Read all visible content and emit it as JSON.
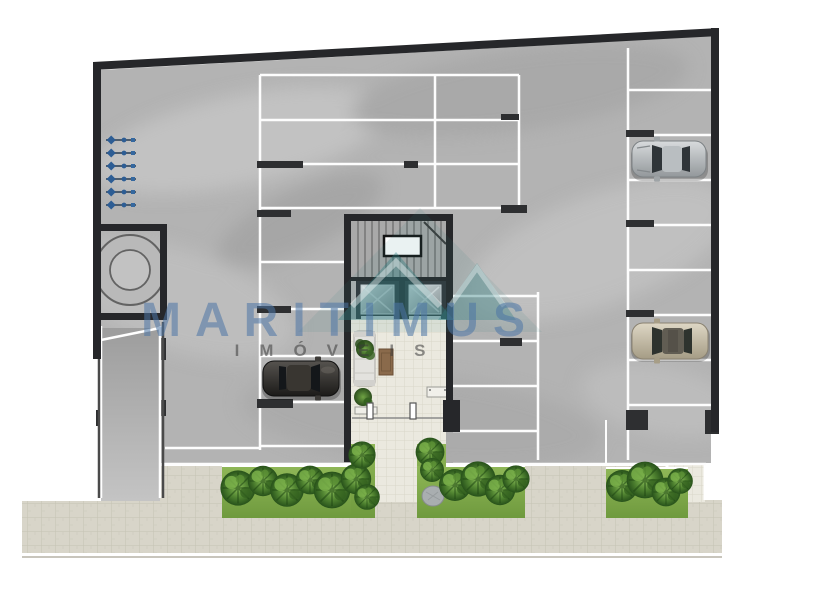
{
  "watermark": {
    "title": "MARITIMUS",
    "subtitle": "IMÓVEIS"
  },
  "plan": {
    "kind": "building ground floor plan with parking garage, lobby, gardens and sidewalk",
    "inventory": {
      "cars": 3,
      "elevators": 2,
      "stairwells": 1,
      "water_tank": 1,
      "utility_meters": 6,
      "garden_beds": 3,
      "entrance_doors": 2
    }
  },
  "colors": {
    "wall": "#26272a",
    "floor": "#b3b3b3",
    "parking_line": "#ffffff",
    "grass": "#84ae4e",
    "lobby_tile": "#ebe9df",
    "sidewalk_paver": "#d8d5c9",
    "watermark_logo": "#2f7d80",
    "watermark_text": "#4d76a6",
    "car_silver": "#aab0b3",
    "car_dark": "#2b2926",
    "car_champagne": "#c2baa5"
  }
}
